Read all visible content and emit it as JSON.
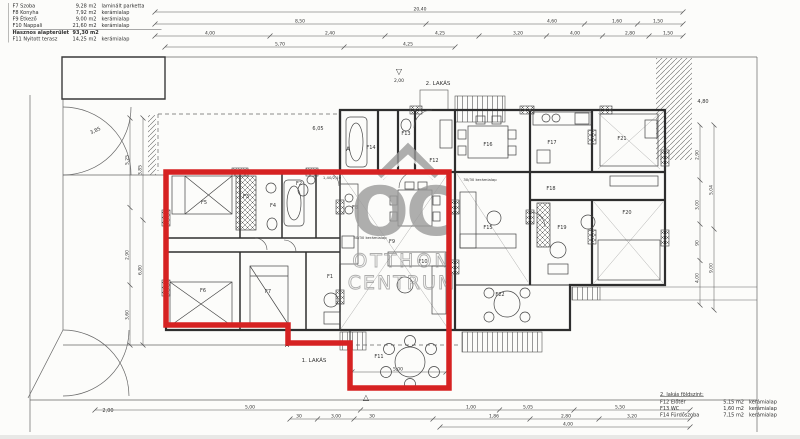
{
  "colors": {
    "highlight_red": "#d62222",
    "ink": "#2e2e2e",
    "thin_line": "#555555",
    "watermark_gray": "#9b9b9b",
    "paper": "#fcfcfa"
  },
  "legend_top_left": {
    "rows": [
      {
        "code": "F7 Szoba",
        "area": "9,28 m2",
        "finish": "laminált parketta"
      },
      {
        "code": "F8 Konyha",
        "area": "7,92 m2",
        "finish": "kerámialap"
      },
      {
        "code": "F9 Étkező",
        "area": "9,00 m2",
        "finish": "kerámialap"
      },
      {
        "code": "F10 Nappali",
        "area": "21,60 m2",
        "finish": "kerámialap"
      },
      {
        "code": "Hasznos alapterület",
        "area": "93,30 m2",
        "finish": ""
      },
      {
        "code": "F11 Nyitott terasz",
        "area": "14,25 m2",
        "finish": "kerámialap"
      }
    ]
  },
  "legend_bottom_right": {
    "title": "2. lakás földszint:",
    "rows": [
      {
        "code": "F12 Előtér",
        "area": "5,15 m2",
        "finish": "kerámialap"
      },
      {
        "code": "F13 WC",
        "area": "1,60 m2",
        "finish": "kerámialap"
      },
      {
        "code": "F14 Fürdőszoba",
        "area": "7,15 m2",
        "finish": "kerámialap"
      }
    ]
  },
  "watermark": {
    "abbr": "OC",
    "line1": "OTTHON",
    "line2": "CENTRUM"
  },
  "plan": {
    "rooms": [
      {
        "id": "F1",
        "x": 330,
        "y": 278
      },
      {
        "id": "F2",
        "x": 299,
        "y": 185
      },
      {
        "id": "F3",
        "x": 246,
        "y": 198
      },
      {
        "id": "F4",
        "x": 273,
        "y": 207
      },
      {
        "id": "F5",
        "x": 204,
        "y": 204
      },
      {
        "id": "F6",
        "x": 203,
        "y": 292
      },
      {
        "id": "F7",
        "x": 268,
        "y": 293
      },
      {
        "id": "F8",
        "x": 355,
        "y": 209
      },
      {
        "id": "F9",
        "x": 392,
        "y": 243
      },
      {
        "id": "F10",
        "x": 423,
        "y": 263
      },
      {
        "id": "F11",
        "x": 379,
        "y": 358
      },
      {
        "id": "F12",
        "x": 434,
        "y": 162
      },
      {
        "id": "F13",
        "x": 406,
        "y": 135
      },
      {
        "id": "F14",
        "x": 371,
        "y": 149
      },
      {
        "id": "F15",
        "x": 488,
        "y": 229
      },
      {
        "id": "F16",
        "x": 488,
        "y": 146
      },
      {
        "id": "F17",
        "x": 552,
        "y": 144
      },
      {
        "id": "F18",
        "x": 551,
        "y": 190
      },
      {
        "id": "F19",
        "x": 562,
        "y": 229
      },
      {
        "id": "F20",
        "x": 627,
        "y": 214
      },
      {
        "id": "F21",
        "x": 622,
        "y": 140
      },
      {
        "id": "F22",
        "x": 500,
        "y": 296
      }
    ],
    "notes": [
      {
        "t": "2. LAKÁS",
        "x": 438,
        "y": 85,
        "s": 5.5
      },
      {
        "t": "1. LAKÁS",
        "x": 314,
        "y": 362,
        "s": 5.5
      },
      {
        "t": "▽",
        "x": 399,
        "y": 74,
        "s": 8
      },
      {
        "t": "2,00",
        "x": 399,
        "y": 82,
        "s": 4.5
      },
      {
        "t": "△",
        "x": 366,
        "y": 400,
        "s": 8
      },
      {
        "t": "2,00",
        "x": 108,
        "y": 412,
        "s": 5
      },
      {
        "t": "6,05",
        "x": 318,
        "y": 130,
        "s": 5
      },
      {
        "t": "4,80",
        "x": 703,
        "y": 103,
        "s": 5
      },
      {
        "t": "3,85",
        "x": 96,
        "y": 132,
        "s": 5,
        "r": -25
      },
      {
        "t": "A",
        "x": 348,
        "y": 151,
        "s": 6
      },
      {
        "t": "A",
        "x": 287,
        "y": 347,
        "s": 6
      },
      {
        "t": "1,40/2,10",
        "x": 332,
        "y": 179,
        "s": 3.8
      },
      {
        "t": "30/30 kerámialap",
        "x": 370,
        "y": 239,
        "s": 3.8
      },
      {
        "t": "30/30 kerámialap",
        "x": 480,
        "y": 181,
        "s": 3.8
      }
    ],
    "dims": [
      {
        "o": "h",
        "pos": 12,
        "a": 155,
        "b": 683,
        "labels": [
          {
            "t": "20,40",
            "at": 420
          }
        ]
      },
      {
        "o": "h",
        "pos": 24,
        "a": 155,
        "b": 683,
        "labels": [
          {
            "t": "8,50",
            "at": 300
          },
          {
            "t": "4,60",
            "at": 552
          },
          {
            "t": "1,60",
            "at": 617
          },
          {
            "t": "1,50",
            "at": 658
          }
        ]
      },
      {
        "o": "h",
        "pos": 36,
        "a": 155,
        "b": 683,
        "labels": [
          {
            "t": "4,00",
            "at": 210
          },
          {
            "t": "2,40",
            "at": 330
          },
          {
            "t": "4,25",
            "at": 440
          },
          {
            "t": "3,20",
            "at": 518
          },
          {
            "t": "4,00",
            "at": 575
          },
          {
            "t": "2,80",
            "at": 630
          },
          {
            "t": "1,50",
            "at": 668
          }
        ]
      },
      {
        "o": "h",
        "pos": 47,
        "a": 165,
        "b": 455,
        "labels": [
          {
            "t": "5,70",
            "at": 280
          },
          {
            "t": "4,25",
            "at": 408
          }
        ]
      },
      {
        "o": "v",
        "pos": 130,
        "a": 118,
        "b": 345,
        "labels": [
          {
            "t": "5,25",
            "at": 160
          },
          {
            "t": "2,90",
            "at": 255
          },
          {
            "t": "3,60",
            "at": 315
          }
        ]
      },
      {
        "o": "v",
        "pos": 143,
        "a": 118,
        "b": 345,
        "labels": [
          {
            "t": "3,85",
            "at": 170
          },
          {
            "t": "6,80",
            "at": 270
          }
        ]
      },
      {
        "o": "v",
        "pos": 700,
        "a": 125,
        "b": 305,
        "labels": [
          {
            "t": "2,90",
            "at": 155
          },
          {
            "t": "3,00",
            "at": 205
          },
          {
            "t": "90",
            "at": 243
          },
          {
            "t": "4,00",
            "at": 278
          }
        ]
      },
      {
        "o": "v",
        "pos": 714,
        "a": 125,
        "b": 310,
        "labels": [
          {
            "t": "5,04",
            "at": 190
          },
          {
            "t": "9,00",
            "at": 268
          }
        ]
      },
      {
        "o": "h",
        "pos": 410,
        "a": 95,
        "b": 690,
        "labels": [
          {
            "t": "5,00",
            "at": 250
          },
          {
            "t": "1,00",
            "at": 471
          },
          {
            "t": "5,05",
            "at": 528
          },
          {
            "t": "5,50",
            "at": 620
          }
        ]
      },
      {
        "o": "h",
        "pos": 419,
        "a": 290,
        "b": 690,
        "labels": [
          {
            "t": "30",
            "at": 299
          },
          {
            "t": "3,00",
            "at": 336
          },
          {
            "t": "30",
            "at": 372
          },
          {
            "t": "1,86",
            "at": 494
          },
          {
            "t": "2,80",
            "at": 566
          },
          {
            "t": "3,20",
            "at": 632
          }
        ]
      },
      {
        "o": "h",
        "pos": 427,
        "a": 440,
        "b": 690,
        "labels": [
          {
            "t": "4,00",
            "at": 568
          }
        ]
      },
      {
        "o": "h",
        "pos": 372,
        "a": 352,
        "b": 446,
        "labels": [
          {
            "t": "5,00",
            "at": 398
          }
        ]
      }
    ]
  }
}
